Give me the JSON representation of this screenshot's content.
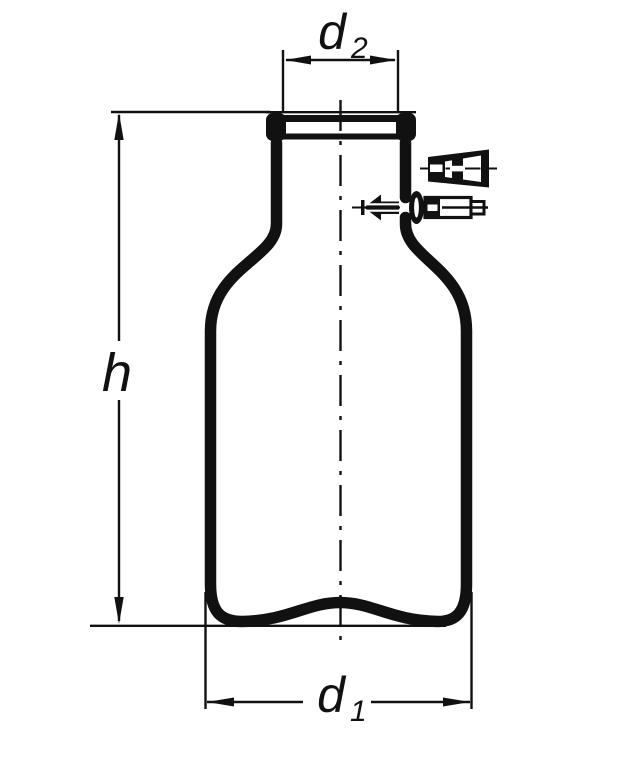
{
  "figure": {
    "type": "technical line drawing",
    "subject": "laboratory bottle with side hose connection, exploded cap and nipple",
    "background_color": "#ffffff",
    "ink_color": "#111111",
    "labels": {
      "d2": {
        "base": "d",
        "sub": "2"
      },
      "h": {
        "base": "h"
      },
      "d1": {
        "base": "d",
        "sub": "1"
      }
    }
  }
}
